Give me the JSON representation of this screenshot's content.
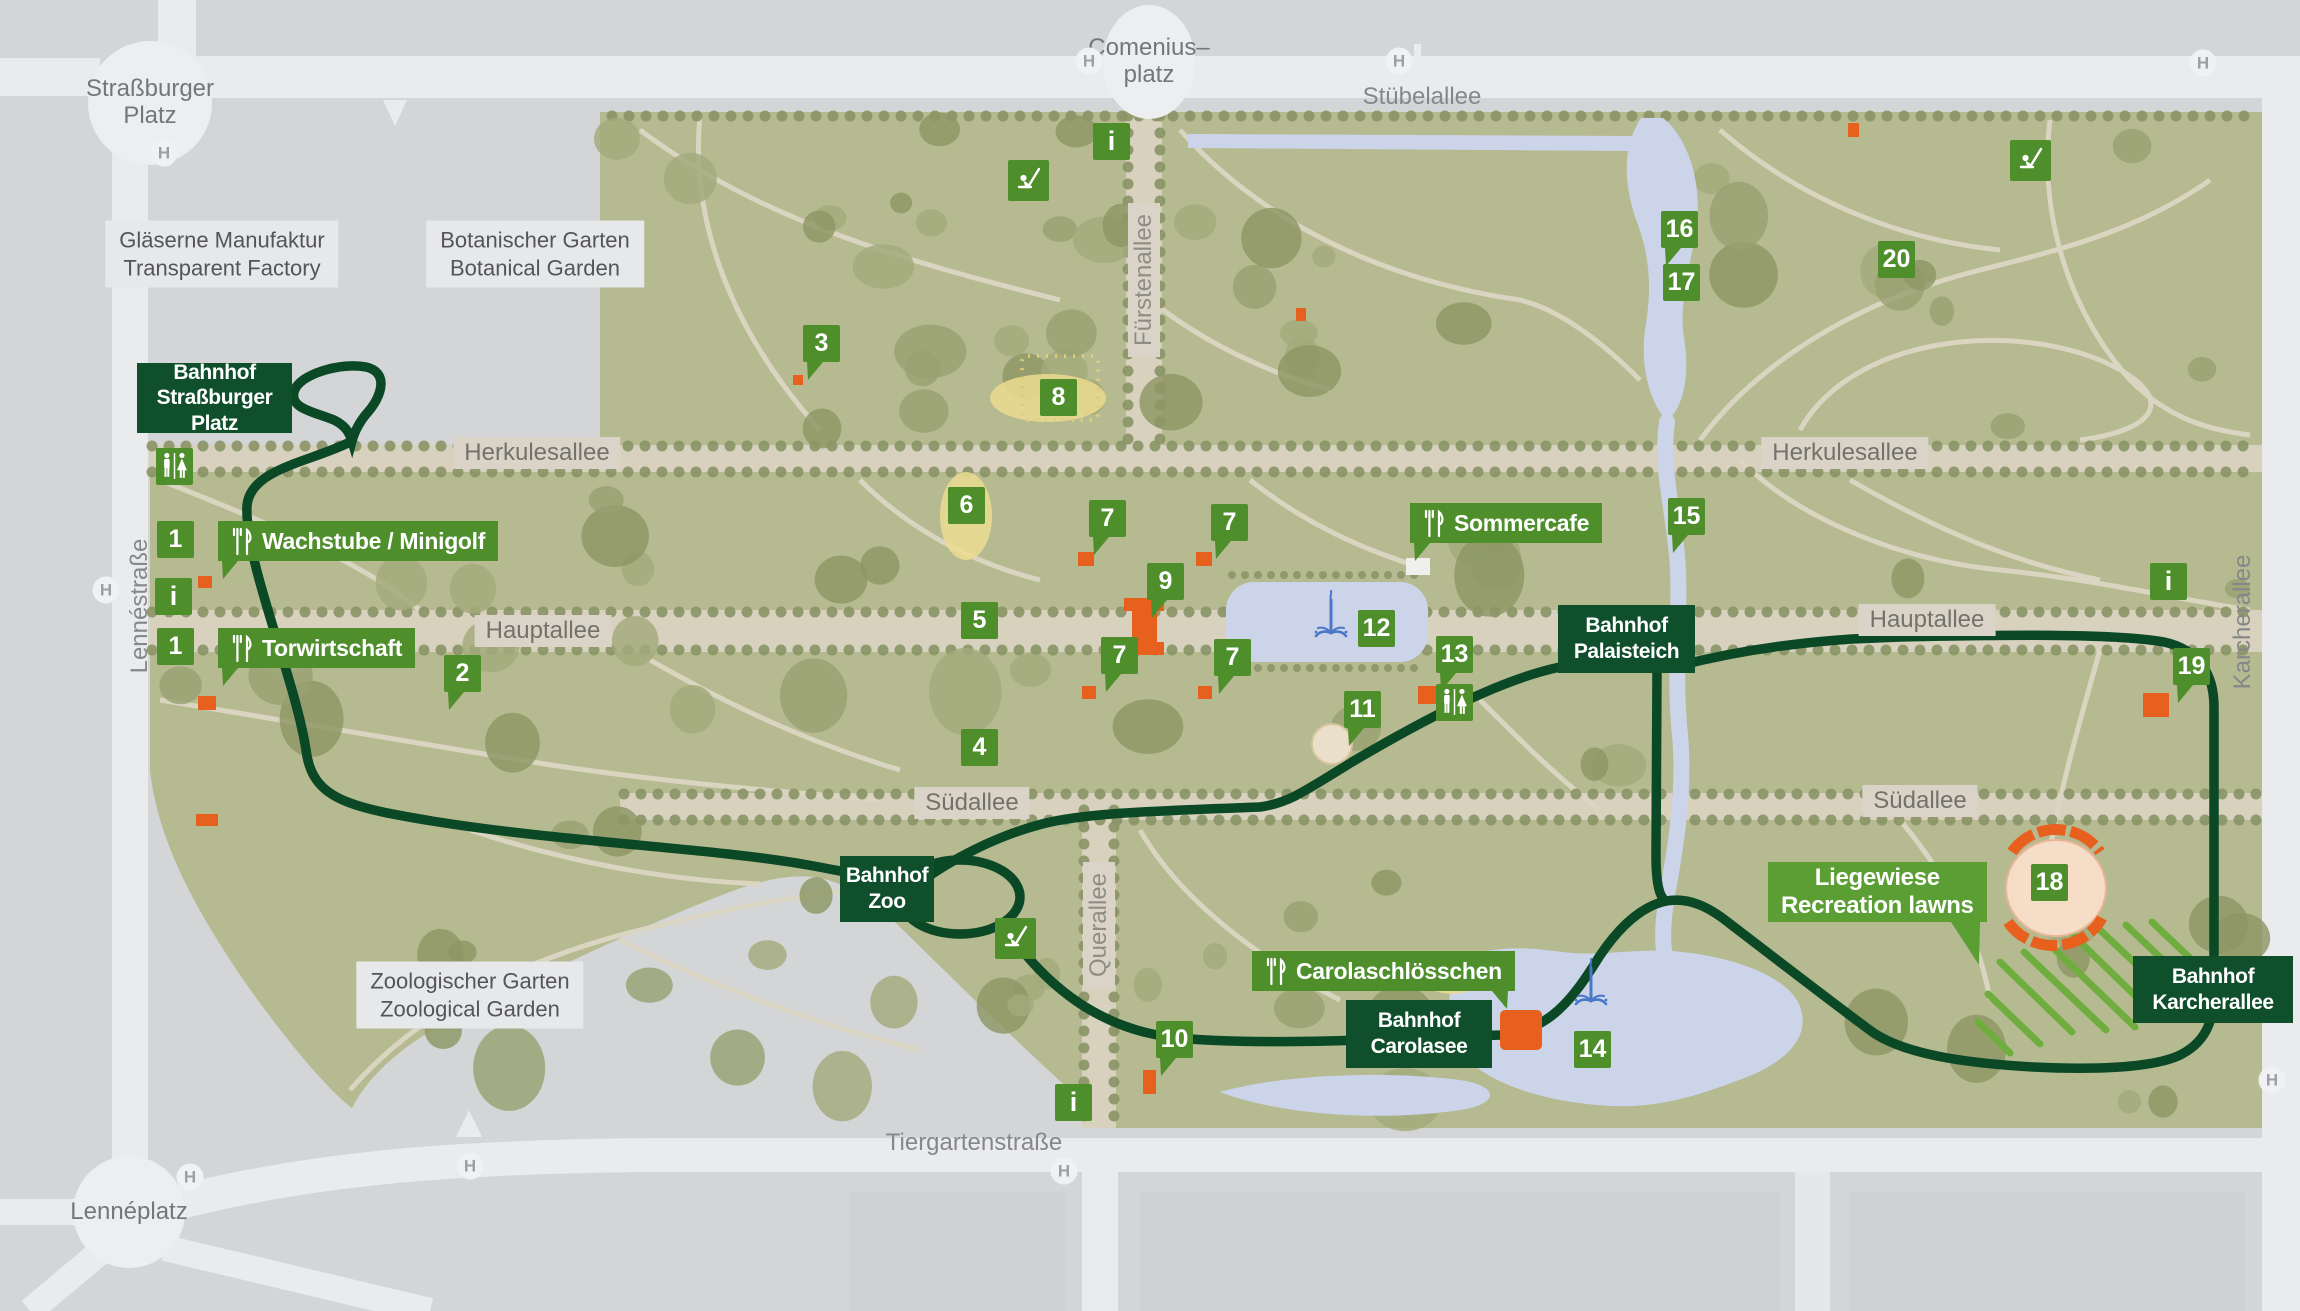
{
  "colors": {
    "background_gray": "#d3d5d7",
    "street_white": "#eaebed",
    "park_olive": "#b6ba91",
    "tree_dark": "#8a9365",
    "allee_tan": "#d7d1be",
    "path_tan": "#dbd6c3",
    "water_blue": "#ccd4ea",
    "route_green": "#0b4826",
    "station_green": "#0f4f2b",
    "marker_green": "#4e8f2c",
    "label_light_green": "#5b9e33",
    "building_orange": "#e7601d",
    "hatch_green": "#6fae3e",
    "fountain_blue": "#4a77c8",
    "chip_beige": "#d9d4c7",
    "area_chip": "#e7e8e9"
  },
  "icons": {
    "stop": "H",
    "info": "i"
  },
  "stations": [
    {
      "id": "strassburger-platz",
      "lines": [
        "Bahnhof",
        "Straßburger Platz"
      ],
      "x": 137,
      "y": 363,
      "w": 155,
      "h": 70
    },
    {
      "id": "zoo",
      "lines": [
        "Bahnhof",
        "Zoo"
      ],
      "x": 840,
      "y": 856,
      "w": 94,
      "h": 66
    },
    {
      "id": "palaisteich",
      "lines": [
        "Bahnhof",
        "Palaisteich"
      ],
      "x": 1558,
      "y": 605,
      "w": 137,
      "h": 68
    },
    {
      "id": "carolasee",
      "lines": [
        "Bahnhof",
        "Carolasee"
      ],
      "x": 1346,
      "y": 1000,
      "w": 146,
      "h": 68
    },
    {
      "id": "karcherallee",
      "lines": [
        "Bahnhof",
        "Karcherallee"
      ],
      "x": 2133,
      "y": 956,
      "w": 160,
      "h": 67
    }
  ],
  "pois": [
    {
      "id": "wachstube-minigolf",
      "text": "Wachstube / Minigolf",
      "x": 218,
      "y": 521,
      "tail": "bl"
    },
    {
      "id": "torwirtschaft",
      "text": "Torwirtschaft",
      "x": 218,
      "y": 628,
      "tail": "bl"
    },
    {
      "id": "sommercafe",
      "text": "Sommercafe",
      "x": 1410,
      "y": 503,
      "tail": "bl"
    },
    {
      "id": "carolaschloesschen",
      "text": "Carolaschlösschen",
      "x": 1252,
      "y": 951,
      "tail": "br"
    }
  ],
  "liegewiese": {
    "id": "liegewiese",
    "lines": [
      "Liegewiese",
      "Recreation lawns"
    ],
    "x": 1768,
    "y": 862,
    "tail": "br"
  },
  "markers": [
    {
      "n": "1",
      "type": "square",
      "x": 157,
      "y": 521
    },
    {
      "n": "1",
      "type": "square",
      "x": 157,
      "y": 628
    },
    {
      "n": "2",
      "type": "pointer",
      "x": 444,
      "y": 655
    },
    {
      "n": "3",
      "type": "pointer",
      "x": 803,
      "y": 325
    },
    {
      "n": "4",
      "type": "square",
      "x": 961,
      "y": 729
    },
    {
      "n": "5",
      "type": "square",
      "x": 961,
      "y": 602
    },
    {
      "n": "6",
      "type": "square",
      "x": 948,
      "y": 487
    },
    {
      "n": "7",
      "type": "pointer",
      "x": 1089,
      "y": 500
    },
    {
      "n": "7",
      "type": "pointer",
      "x": 1211,
      "y": 504
    },
    {
      "n": "7",
      "type": "pointer",
      "x": 1101,
      "y": 637
    },
    {
      "n": "7",
      "type": "pointer",
      "x": 1214,
      "y": 639
    },
    {
      "n": "8",
      "type": "square",
      "x": 1040,
      "y": 379
    },
    {
      "n": "9",
      "type": "pointer",
      "x": 1147,
      "y": 563
    },
    {
      "n": "10",
      "type": "pointer",
      "x": 1156,
      "y": 1021
    },
    {
      "n": "11",
      "type": "pointer",
      "x": 1344,
      "y": 691
    },
    {
      "n": "12",
      "type": "square",
      "x": 1358,
      "y": 610
    },
    {
      "n": "13",
      "type": "pointer",
      "x": 1436,
      "y": 636
    },
    {
      "n": "14",
      "type": "square",
      "x": 1574,
      "y": 1031
    },
    {
      "n": "15",
      "type": "pointer",
      "x": 1668,
      "y": 498
    },
    {
      "n": "16",
      "type": "pointer",
      "x": 1661,
      "y": 211
    },
    {
      "n": "17",
      "type": "square",
      "x": 1663,
      "y": 264
    },
    {
      "n": "18",
      "type": "square",
      "x": 2031,
      "y": 864
    },
    {
      "n": "19",
      "type": "pointer",
      "x": 2173,
      "y": 648
    },
    {
      "n": "20",
      "type": "square",
      "x": 1878,
      "y": 241
    }
  ],
  "info_points": [
    {
      "x": 1093,
      "y": 123
    },
    {
      "x": 155,
      "y": 578
    },
    {
      "x": 2150,
      "y": 563
    },
    {
      "x": 1055,
      "y": 1084
    }
  ],
  "wc_points": [
    {
      "x": 156,
      "y": 448
    },
    {
      "x": 1436,
      "y": 684
    }
  ],
  "playground_points": [
    {
      "x": 1008,
      "y": 160
    },
    {
      "x": 2010,
      "y": 140
    },
    {
      "x": 995,
      "y": 918
    }
  ],
  "fountain_points": [
    {
      "x": 1312,
      "y": 588
    },
    {
      "x": 1572,
      "y": 956
    }
  ],
  "streets": [
    {
      "id": "stuebelallee",
      "text": "Stübelallee",
      "x": 1422,
      "y": 97,
      "kind": "plain"
    },
    {
      "id": "herkulesallee-west",
      "text": "Herkulesallee",
      "x": 537,
      "y": 453,
      "kind": "chip"
    },
    {
      "id": "herkulesallee-east",
      "text": "Herkulesallee",
      "x": 1845,
      "y": 453,
      "kind": "chip"
    },
    {
      "id": "hauptallee-west",
      "text": "Hauptallee",
      "x": 543,
      "y": 631,
      "kind": "chip"
    },
    {
      "id": "hauptallee-east",
      "text": "Hauptallee",
      "x": 1927,
      "y": 620,
      "kind": "chip"
    },
    {
      "id": "suedallee-west",
      "text": "Südallee",
      "x": 972,
      "y": 803,
      "kind": "chip"
    },
    {
      "id": "suedallee-east",
      "text": "Südallee",
      "x": 1920,
      "y": 801,
      "kind": "chip"
    },
    {
      "id": "fuerstenallee",
      "text": "Fürstenallee",
      "x": 1144,
      "y": 280,
      "kind": "chip-vert"
    },
    {
      "id": "querallee",
      "text": "Querallee",
      "x": 1099,
      "y": 925,
      "kind": "chip-vert"
    },
    {
      "id": "lennestrasse",
      "text": "Lennéstraße",
      "x": 140,
      "y": 606,
      "kind": "vert"
    },
    {
      "id": "karcherallee-street",
      "text": "Karcherallee",
      "x": 2243,
      "y": 622,
      "kind": "vert"
    },
    {
      "id": "tiergartenstrasse",
      "text": "Tiergartenstraße",
      "x": 974,
      "y": 1143,
      "kind": "plain"
    }
  ],
  "areas": [
    {
      "id": "glaeserne-manufaktur",
      "lines": [
        "Gläserne Manufaktur",
        "Transparent Factory"
      ],
      "x": 222,
      "y": 254
    },
    {
      "id": "botanischer-garten",
      "lines": [
        "Botanischer Garten",
        "Botanical Garden"
      ],
      "x": 535,
      "y": 254
    },
    {
      "id": "zoologischer-garten",
      "lines": [
        "Zoologischer Garten",
        "Zoological Garden"
      ],
      "x": 470,
      "y": 995
    }
  ],
  "plazas": [
    {
      "id": "strassburger-platz-circle",
      "lines": [
        "Straßburger",
        "Platz"
      ],
      "cx": 150,
      "cy": 103,
      "rx": 62,
      "ry": 62
    },
    {
      "id": "comeniusplatz-circle",
      "lines": [
        "Comenius–",
        "platz"
      ],
      "cx": 1149,
      "cy": 62,
      "rx": 46,
      "ry": 57
    },
    {
      "id": "lenneplatz-circle",
      "lines": [
        "Lennéplatz"
      ],
      "cx": 129,
      "cy": 1212,
      "rx": 56,
      "ry": 56
    }
  ],
  "h_stops": [
    {
      "x": 164,
      "y": 153
    },
    {
      "x": 106,
      "y": 590
    },
    {
      "x": 1089,
      "y": 61
    },
    {
      "x": 1399,
      "y": 61
    },
    {
      "x": 2203,
      "y": 63
    },
    {
      "x": 190,
      "y": 1177
    },
    {
      "x": 470,
      "y": 1166
    },
    {
      "x": 1064,
      "y": 1171
    },
    {
      "x": 2272,
      "y": 1080
    }
  ]
}
